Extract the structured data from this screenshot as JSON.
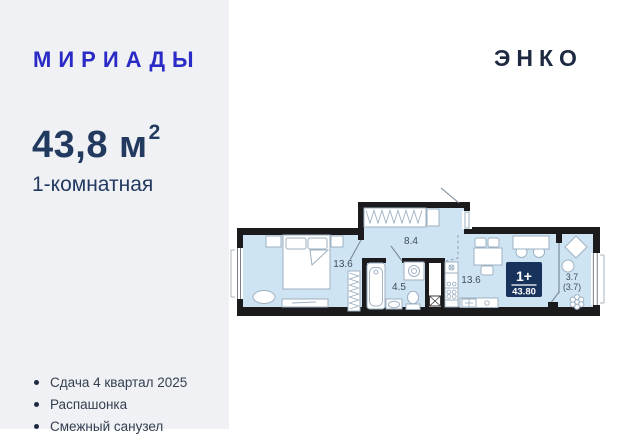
{
  "header": {
    "brand_logo": "МИРИАДЫ",
    "developer_logo": "ЭНКО"
  },
  "listing": {
    "area_value": "43,8 м",
    "area_superscript": "2",
    "room_type": "1-комнатная"
  },
  "features": {
    "items": [
      "Сдача 4 квартал 2025",
      "Распашонка",
      "Смежный санузел"
    ]
  },
  "plan": {
    "labels": {
      "bedroom_area": "13.6",
      "hall_area": "8.4",
      "bathroom_area": "4.5",
      "living_area": "13.6",
      "balcony_area": "3.7",
      "balcony_area_coef": "(3.7)"
    },
    "badge": {
      "rooms": "1+",
      "total_area": "43.80"
    }
  },
  "colors": {
    "brand_blue": "#2a2ac6",
    "logo_navy": "#1d2841",
    "text_navy": "#233a60",
    "badge_navy": "#17335c",
    "plan_fill": "#cfe4f2",
    "wall_black": "#1b1b1d",
    "panel_gray": "#f0f1f4"
  }
}
